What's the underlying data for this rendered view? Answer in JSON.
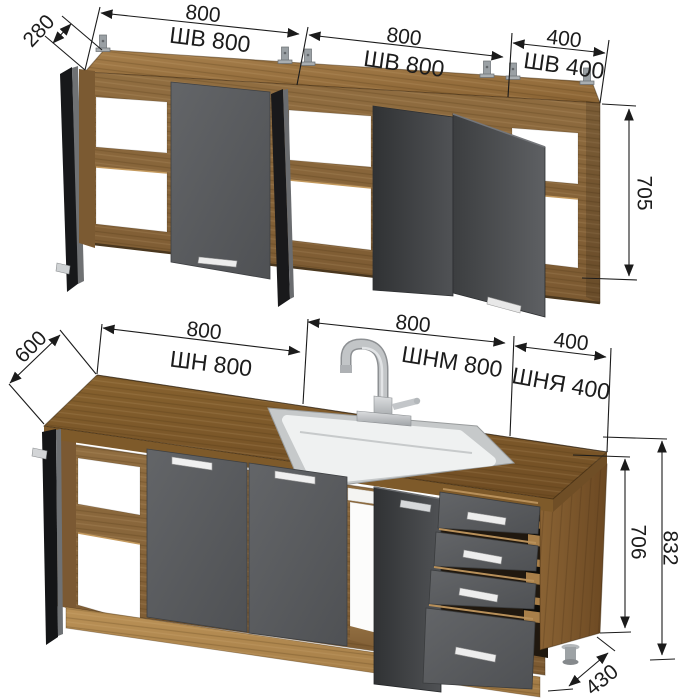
{
  "diagram": {
    "wall_cabinets": {
      "depth": "280",
      "height": "705",
      "items": [
        {
          "width": "800",
          "code": "ШВ 800"
        },
        {
          "width": "800",
          "code": "ШВ 800"
        },
        {
          "width": "400",
          "code": "ШВ 400"
        }
      ]
    },
    "base_cabinets": {
      "depth": "600",
      "carcass_height": "706",
      "total_height": "832",
      "bottom_depth": "430",
      "items": [
        {
          "width": "800",
          "code": "ШН 800"
        },
        {
          "width": "800",
          "code": "ШНМ 800"
        },
        {
          "width": "400",
          "code": "ШНЯ 400"
        }
      ]
    },
    "colors": {
      "background": "#ffffff",
      "wood": "#8a683e",
      "countertop": "#7d5c30",
      "plinth": "#b28a52",
      "door_gray": "#57595c",
      "open_door_dark": "#1a1b1d",
      "handle": "#ededed",
      "sink": "#eef0f0",
      "dimension_ink": "#1b1b1b"
    }
  }
}
